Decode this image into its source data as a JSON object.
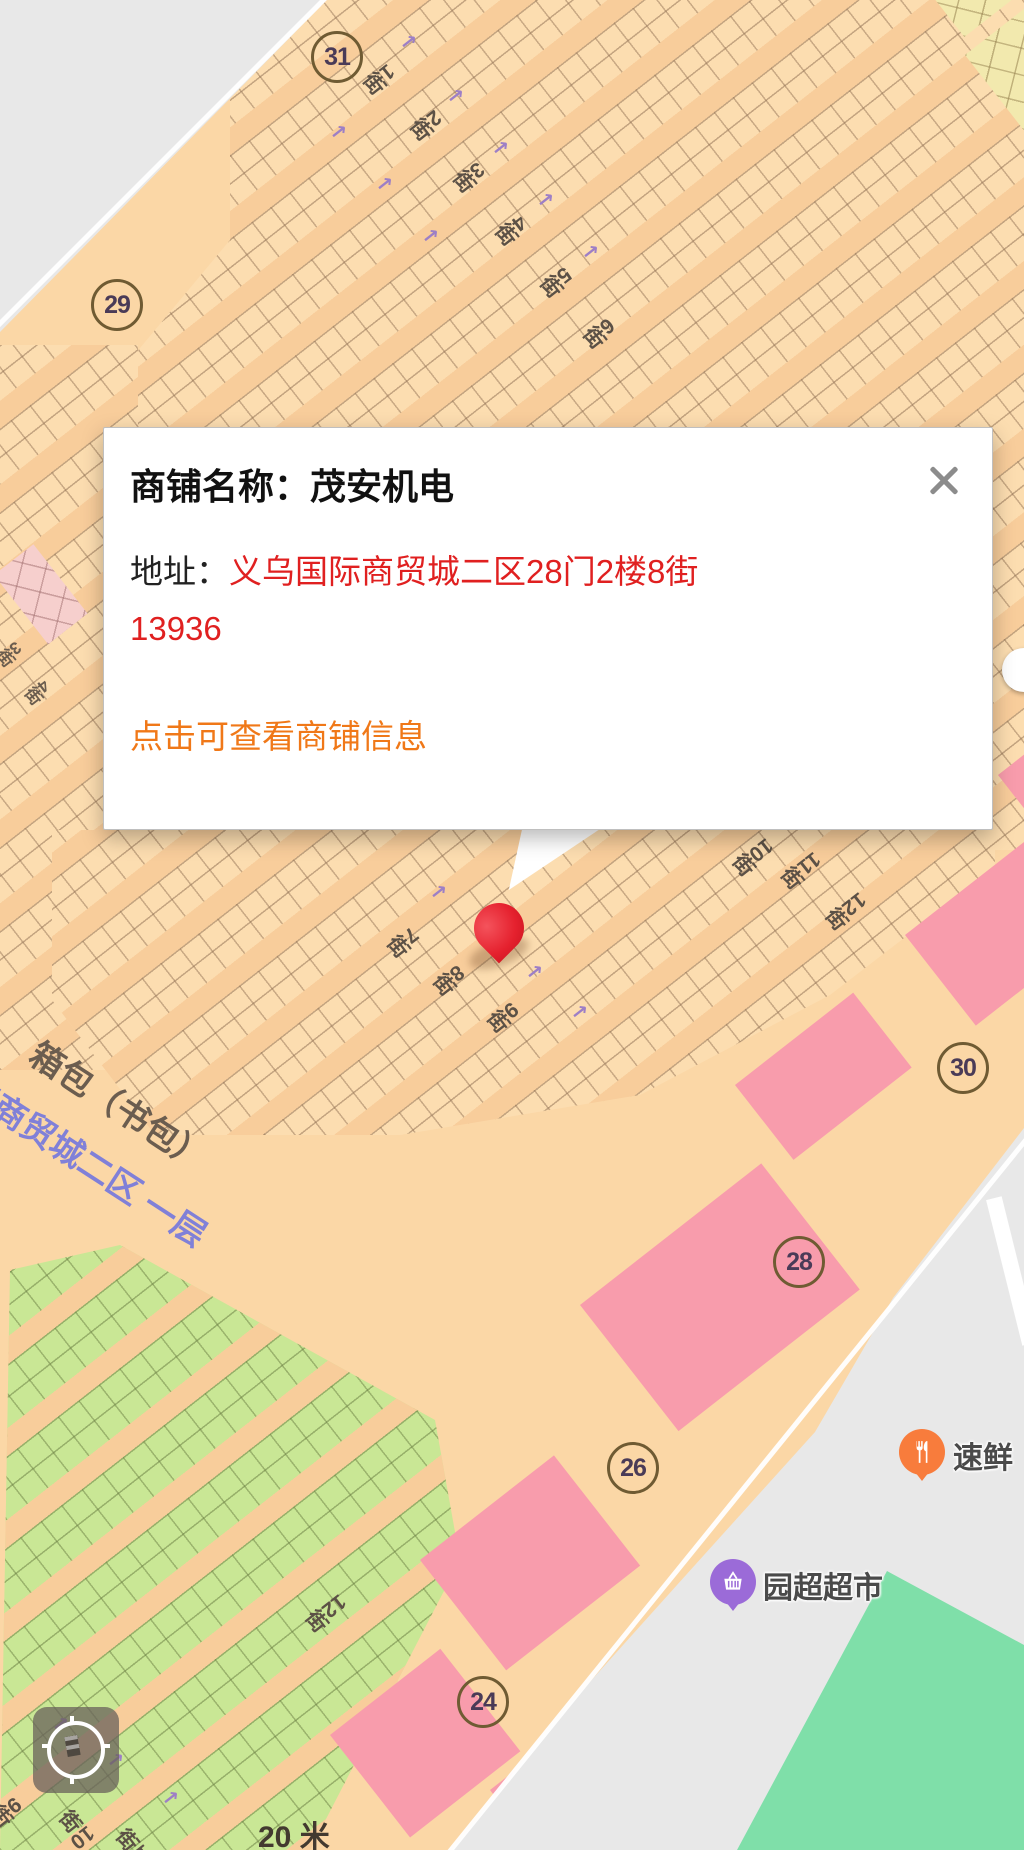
{
  "popup": {
    "title": "商铺名称：茂安机电",
    "address_label": "地址：",
    "address_value": "义乌国际商贸城二区28门2楼8街13936",
    "link_text": "点击可查看商铺信息"
  },
  "map": {
    "gates": [
      "31",
      "29",
      "30",
      "28",
      "26",
      "24"
    ],
    "streets_top": [
      "1街",
      "2街",
      "3街",
      "4街",
      "5街",
      "6街"
    ],
    "streets_left": [
      "3街",
      "4街"
    ],
    "streets_mid": [
      "7街",
      "8街",
      "9街",
      "10街",
      "11街",
      "12街"
    ],
    "streets_bottom": [
      "9街",
      "10街",
      "11街",
      "12街"
    ],
    "area_label_dark": "箱包（书包）",
    "area_label_blue": "际商贸城二区  一层",
    "pois": [
      {
        "name": "速鲜"
      },
      {
        "name": "园超超市"
      }
    ],
    "scale_text": "20 米"
  },
  "colors": {
    "building": "#FBD7A6",
    "outside_gray": "#E8E8E8",
    "pink_block": "#F89CAC",
    "green_stalls": "#C9E795",
    "yellow_stalls": "#F2E9AE",
    "teal_area": "#7FDFA9",
    "address_red": "#E02020",
    "link_orange": "#F07818",
    "poi_orange": "#F87C3C",
    "poi_purple": "#9B6BD8",
    "pin_red": "#E5212E",
    "street_text": "#5C5146",
    "blue_label": "#8080D8"
  }
}
